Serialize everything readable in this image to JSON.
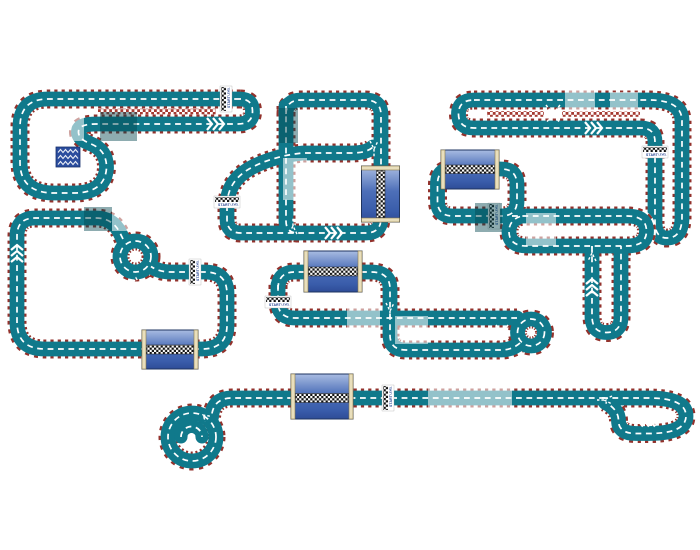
{
  "image": {
    "title": "Toy race track circuit layout sheet",
    "background": "#ffffff",
    "layout_count": 7
  },
  "labels": {
    "start": "START",
    "level": "LEVEL"
  },
  "colors": {
    "road": "#10798b",
    "edge_red": "#93322c",
    "median_red": "#a53a31",
    "bridge_blue": "#3a5dab",
    "bridge_blue_light": "#a9bce2",
    "bridge_rail": "#e9dfbc",
    "checker_dark": "#111111",
    "label_blue": "#1c3c8f",
    "sign_blue": "#2b4d9e"
  },
  "icons": {
    "chevrons_right": "triple right chevron arrows",
    "chevrons_up": "triple up chevron arrows",
    "chevrons_left": "triple left chevron arrows",
    "crossover_x": "dashed lane crossover X",
    "merge_arrow": "dashed merge Y arrow",
    "roundabout_asterisk": "white asterisk hub",
    "grandstand_sign": "blue sign with white zigzag rows",
    "start_finish_line": "black and white checkered strip"
  },
  "layouts": [
    {
      "name": "top-left-loop-with-spur",
      "position": "top-left",
      "elements": [
        "two-lane straight with checkered median",
        "right U-turn cap",
        "teardrop loop around grandstand sign",
        "start-finish line",
        "chevrons pointing right"
      ]
    },
    {
      "name": "top-middle-circuit",
      "position": "top-center",
      "elements": [
        "vertical bridge",
        "central shortcut road",
        "S-curve link road",
        "start-finish line with LEVEL",
        "chevrons pointing right",
        "merge arrows"
      ]
    },
    {
      "name": "top-right-circuit",
      "position": "top-right",
      "elements": [
        "two-lane straight with checkered medians",
        "lane crossover X",
        "left U-turn cap",
        "right-side vertical hairpin",
        "start-finish line with LEVEL",
        "chevrons pointing right"
      ]
    },
    {
      "name": "left-rectangle-circuit",
      "position": "middle-left",
      "elements": [
        "roundabout with asterisk hub",
        "horizontal bridge on bottom straight",
        "start-finish line",
        "chevrons pointing up"
      ]
    },
    {
      "name": "center-circuit",
      "position": "middle-center",
      "elements": [
        "horizontal bridge on top straight",
        "roundabout turnaround with asterisk hub",
        "crossover X",
        "start-finish line",
        "merge arrow"
      ]
    },
    {
      "name": "right-s-circuit",
      "position": "middle-right",
      "elements": [
        "horizontal bridge over mini loop",
        "long U extension",
        "hairpin spur",
        "start-finish line",
        "chevrons pointing up",
        "merge arrow"
      ]
    },
    {
      "name": "bottom-drag-strip",
      "position": "bottom",
      "elements": [
        "spiral turnaround with asterisk hub",
        "horizontal bridge",
        "start-finish line",
        "paperclip turnaround",
        "chevrons pointing left",
        "merge arrow"
      ]
    }
  ]
}
